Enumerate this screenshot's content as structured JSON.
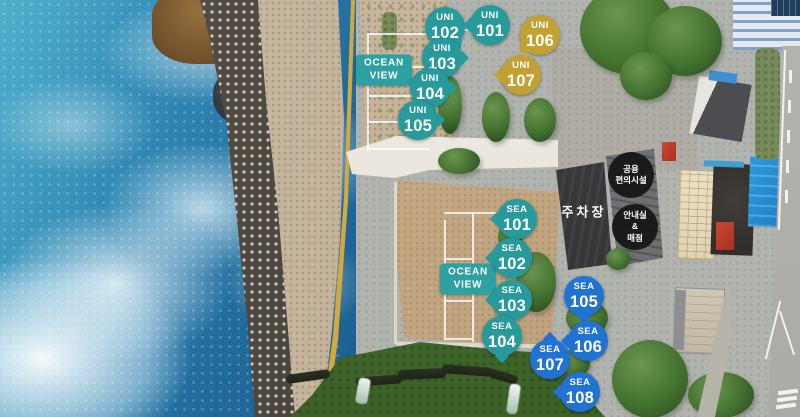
{
  "colors": {
    "teal": "#279a9c",
    "gold": "#c2a133",
    "blue": "#2173d3",
    "badge_dark": "#141414",
    "ocean_view_bg": "#2da0a2"
  },
  "markers": [
    {
      "group": "UNI",
      "number": "102",
      "color": "teal",
      "x": 445,
      "y": 27,
      "tail": 55
    },
    {
      "group": "UNI",
      "number": "101",
      "color": "teal",
      "x": 490,
      "y": 25,
      "tail": 180
    },
    {
      "group": "UNI",
      "number": "106",
      "color": "gold",
      "x": 540,
      "y": 35,
      "tail": 140
    },
    {
      "group": "UNI",
      "number": "103",
      "color": "teal",
      "x": 442,
      "y": 58,
      "tail": 0
    },
    {
      "group": "UNI",
      "number": "107",
      "color": "gold",
      "x": 521,
      "y": 75,
      "tail": 180
    },
    {
      "group": "UNI",
      "number": "104",
      "color": "teal",
      "x": 430,
      "y": 88,
      "tail": 0
    },
    {
      "group": "UNI",
      "number": "105",
      "color": "teal",
      "x": 418,
      "y": 120,
      "tail": 0
    },
    {
      "group": "SEA",
      "number": "101",
      "color": "teal",
      "x": 517,
      "y": 219,
      "tail": 180
    },
    {
      "group": "SEA",
      "number": "102",
      "color": "teal",
      "x": 512,
      "y": 258,
      "tail": 180
    },
    {
      "group": "SEA",
      "number": "103",
      "color": "teal",
      "x": 512,
      "y": 300,
      "tail": 180
    },
    {
      "group": "SEA",
      "number": "104",
      "color": "teal",
      "x": 502,
      "y": 336,
      "tail": 90
    },
    {
      "group": "SEA",
      "number": "105",
      "color": "blue",
      "x": 584,
      "y": 296,
      "tail": 90
    },
    {
      "group": "SEA",
      "number": "106",
      "color": "blue",
      "x": 588,
      "y": 341,
      "tail": 180
    },
    {
      "group": "SEA",
      "number": "107",
      "color": "blue",
      "x": 550,
      "y": 359,
      "tail": 270
    },
    {
      "group": "SEA",
      "number": "108",
      "color": "blue",
      "x": 580,
      "y": 392,
      "tail": 180
    }
  ],
  "area_labels": [
    {
      "id": "ocean-view-upper",
      "line1": "OCEAN",
      "line2": "VIEW",
      "x": 384,
      "y": 70
    },
    {
      "id": "ocean-view-lower",
      "line1": "OCEAN",
      "line2": "VIEW",
      "x": 468,
      "y": 279
    }
  ],
  "facility_badges": [
    {
      "id": "shared-facilities",
      "lines": [
        "공용",
        "편의시설"
      ],
      "x": 631,
      "y": 175
    },
    {
      "id": "info-and-store",
      "lines": [
        "안내실",
        "&",
        "매점"
      ],
      "x": 635,
      "y": 227
    }
  ],
  "ground_labels": [
    {
      "id": "parking",
      "text": "주차장",
      "x": 584,
      "y": 211
    }
  ]
}
